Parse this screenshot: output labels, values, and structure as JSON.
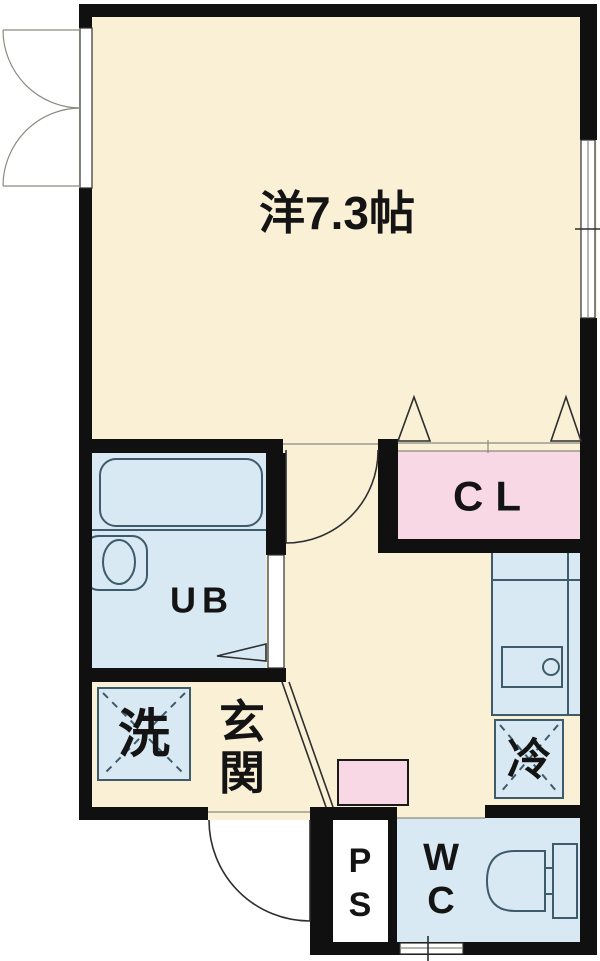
{
  "colors": {
    "wall": "#101010",
    "cream": "#faf0d6",
    "blue": "#d8e9f3",
    "pink": "#f8d8e4",
    "fixture": "#3d5b6b",
    "line": "#2e2e2e",
    "text": "#141414"
  },
  "rooms": {
    "main_room": {
      "label": "洋7.3帖"
    },
    "closet": {
      "label": "CL"
    },
    "unit_bath": {
      "label": "UB"
    },
    "washer_space": {
      "label": "洗"
    },
    "entrance": {
      "label": "玄関",
      "char1": "玄",
      "char2": "関"
    },
    "refrigerator_space": {
      "label": "冷"
    },
    "pipe_space": {
      "label": "PS",
      "char1": "P",
      "char2": "S"
    },
    "toilet_room": {
      "label": "WC",
      "char1": "W",
      "char2": "C"
    }
  }
}
